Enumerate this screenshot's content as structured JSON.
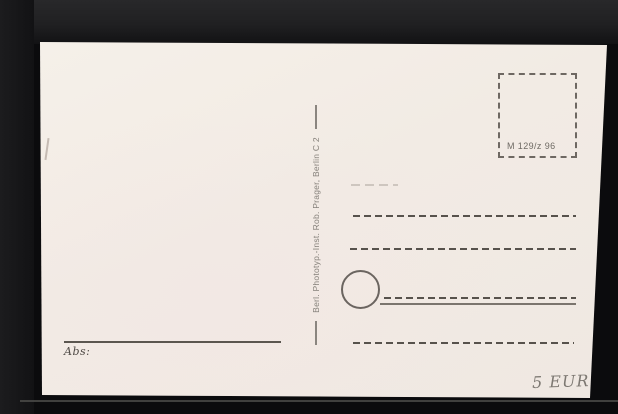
{
  "scene": {
    "description": "Scanned back of a blank vintage postcard on a black scanner background",
    "background_color": "#0b0b0d",
    "scan_edge_color": "#4e4d4b"
  },
  "postcard": {
    "paper_color": "#f2ebe4",
    "ink_color": "#57524c",
    "publisher_imprint": "Berl. Phototyp.-Inst. Rob. Prager, Berlin C 2",
    "stamp_box": {
      "code": "M 129/z 96"
    },
    "address_lines_count": 4,
    "sender_label": "Abs:",
    "price_note": "5 EUR"
  }
}
